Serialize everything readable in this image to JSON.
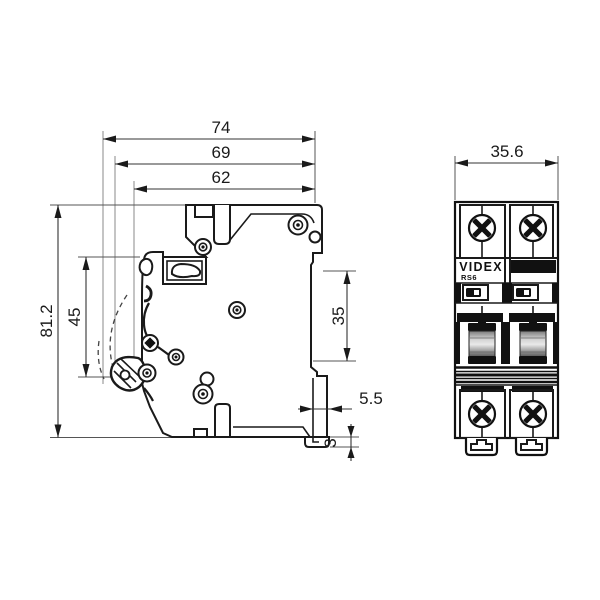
{
  "dims": {
    "d74": "74",
    "d69": "69",
    "d62": "62",
    "h81": "81.2",
    "h45": "45",
    "h35": "35",
    "d55": "5.5",
    "h3": "3",
    "w356": "35.6"
  },
  "front": {
    "brand": "VIDEX",
    "model": "RS6"
  }
}
